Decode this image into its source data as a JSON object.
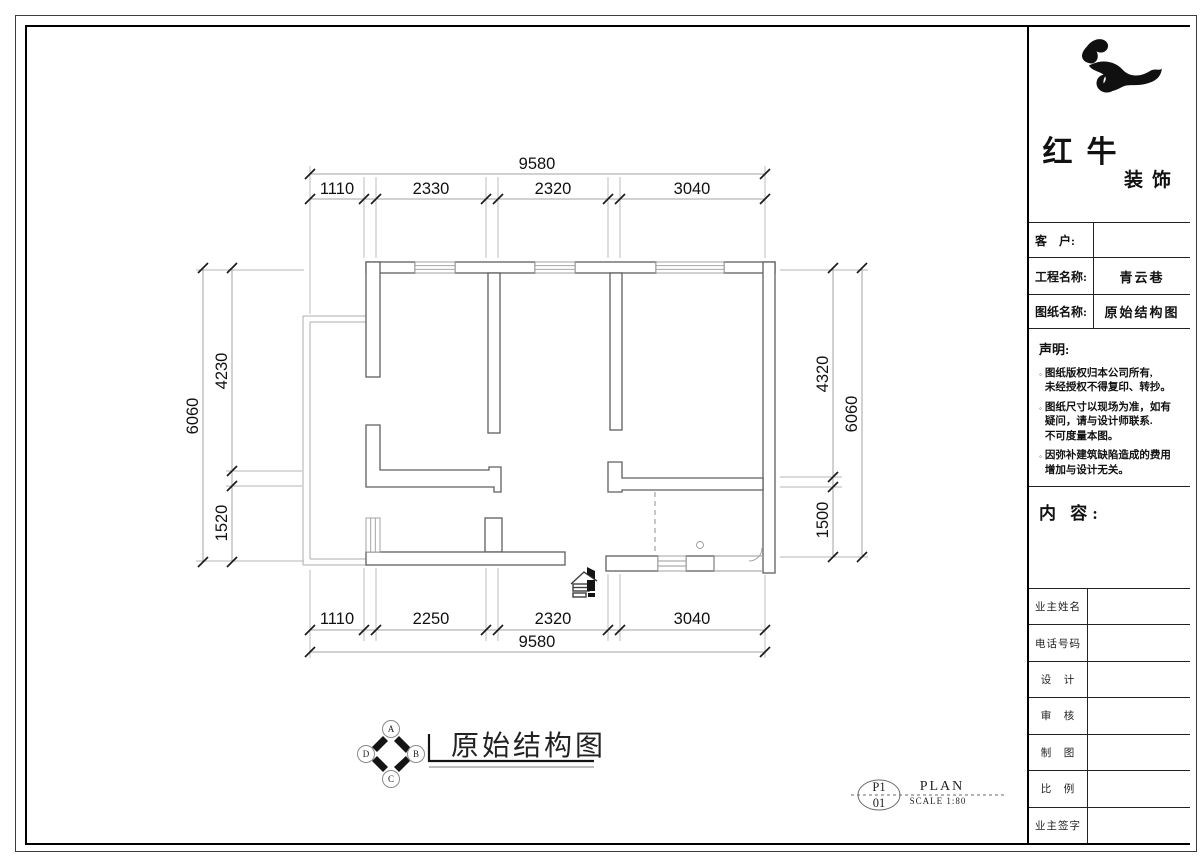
{
  "page": {
    "background": "#ffffff",
    "ink_color": "#1a1a1a",
    "wall_line_color": "#5f5f5f",
    "dimension_line_color": "#a3a3a3"
  },
  "title_block": {
    "brand_main": "红牛",
    "brand_sub": "装饰",
    "fields": [
      {
        "label": "客　户:",
        "value": ""
      },
      {
        "label": "工程名称:",
        "value": "青云巷"
      },
      {
        "label": "图纸名称:",
        "value": "原始结构图"
      }
    ],
    "statement": {
      "heading": "声明:",
      "bullet": "◦",
      "items": [
        "图纸版权归本公司所有,\n未经授权不得复印、转抄。",
        "图纸尺寸以现场为准，如有\n疑问，请与设计师联系.\n不可度量本图。",
        "因弥补建筑缺陷造成的费用\n增加与设计无关。"
      ]
    },
    "content_heading": "内 容:",
    "signature_rows": [
      "业主姓名",
      "电话号码",
      "设　计",
      "审　核",
      "制　图",
      "比　例",
      "业主签字"
    ]
  },
  "drawing": {
    "plan_title": "原始结构图",
    "compass": [
      "A",
      "B",
      "C",
      "D"
    ],
    "ref": {
      "sheet": "P1",
      "number": "01",
      "name": "PLAN",
      "scale": "SCALE 1:80"
    },
    "dims": {
      "top_total": "9580",
      "top_segments": [
        "1110",
        "2330",
        "2320",
        "3040"
      ],
      "bottom_segments": [
        "1110",
        "2250",
        "2320",
        "3040"
      ],
      "bottom_total": "9580",
      "left_segments": [
        "4230",
        "1520"
      ],
      "left_total": "6060",
      "right_segments": [
        "4320",
        "1500"
      ],
      "right_total": "6060"
    }
  }
}
